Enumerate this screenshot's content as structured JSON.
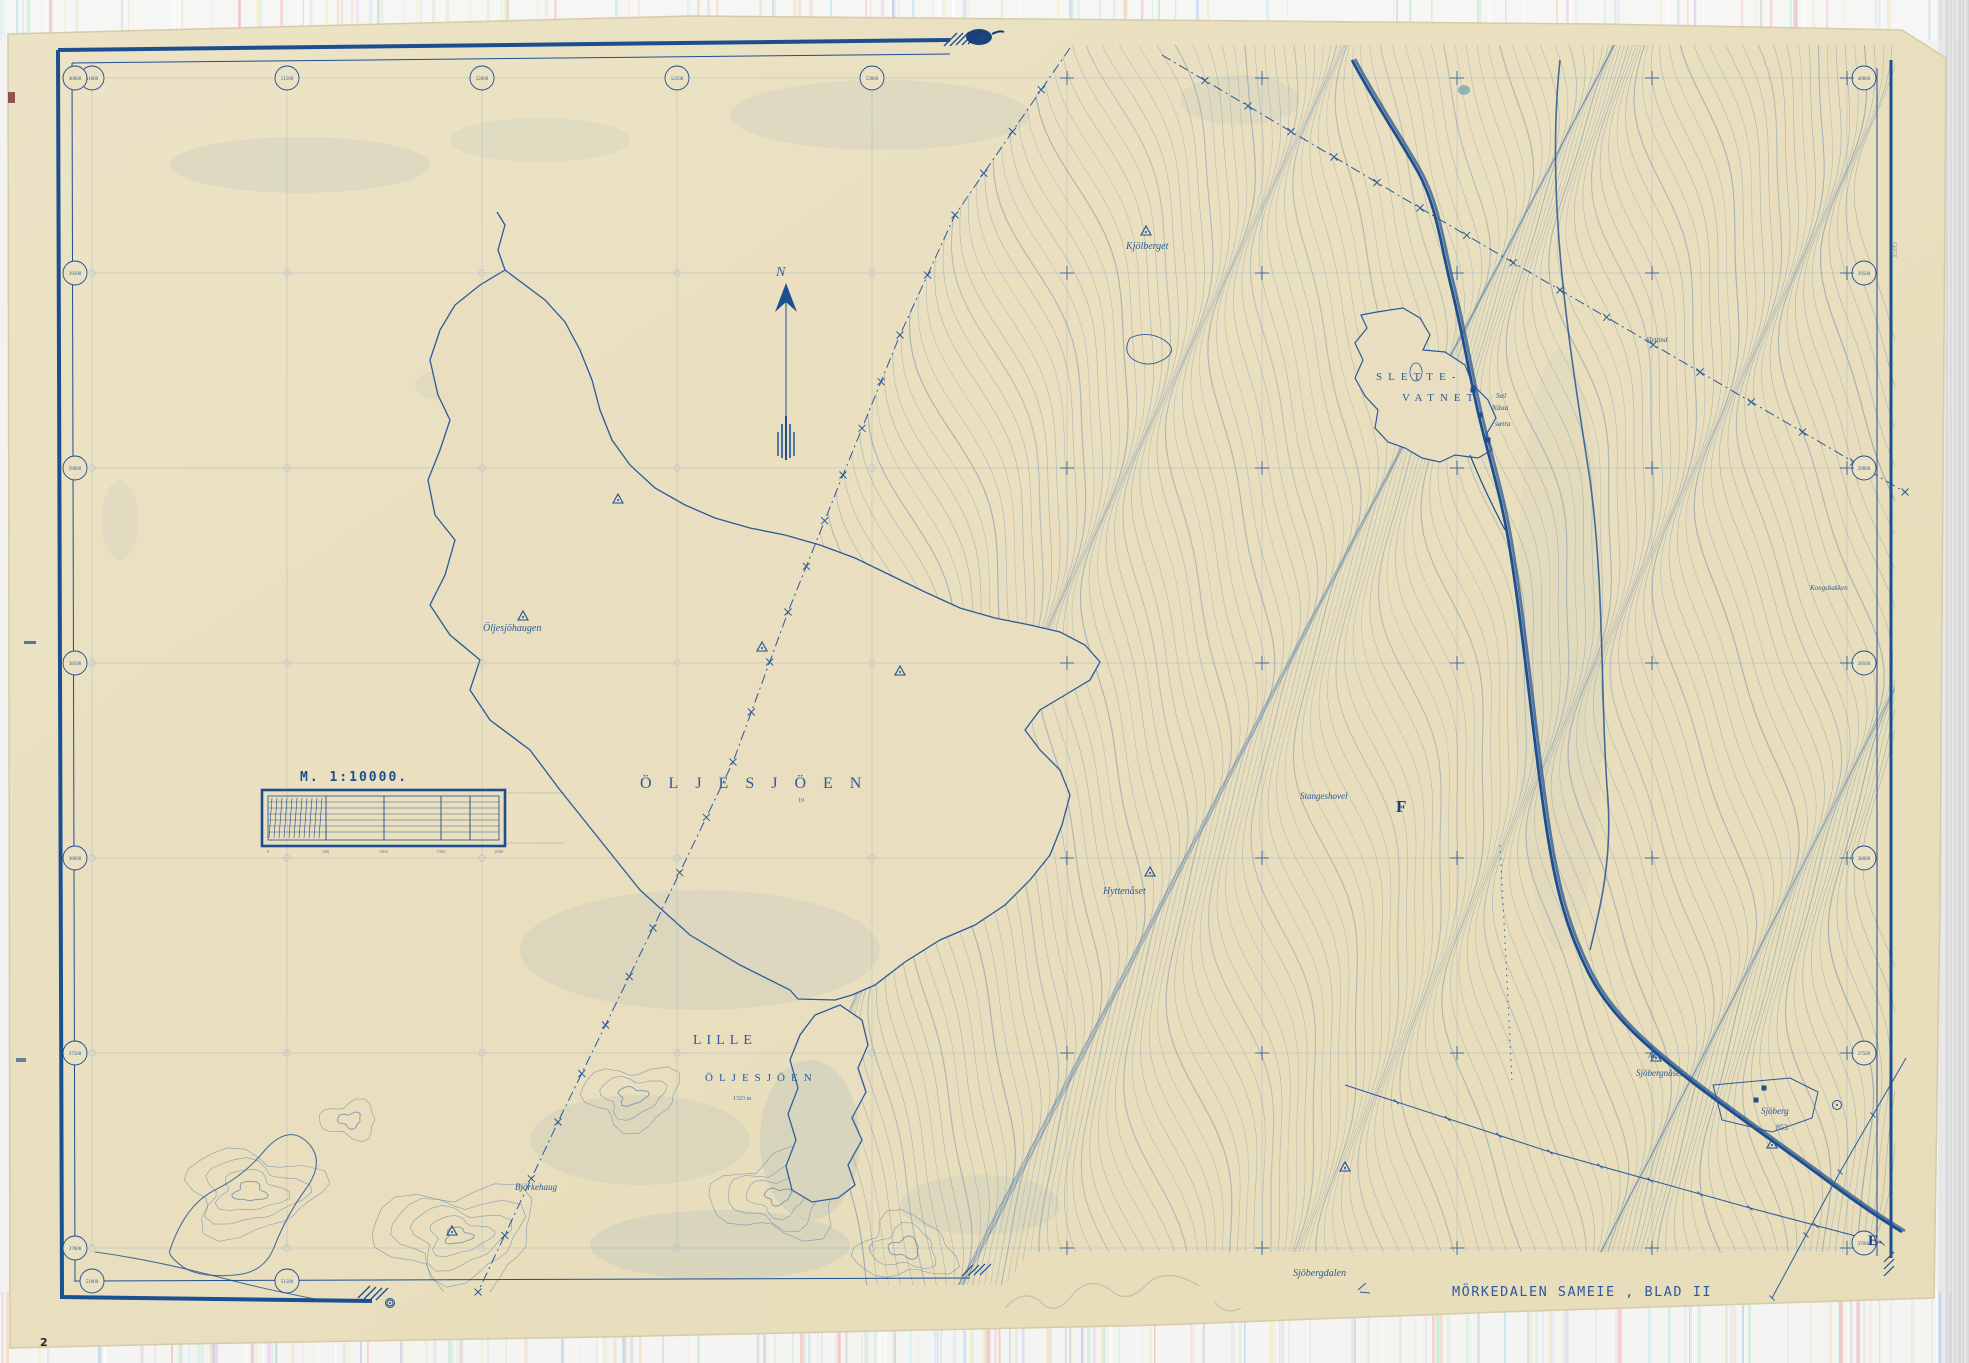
{
  "colors": {
    "paper": "#eae0c2",
    "ink": "#1d4e8f",
    "mid": "#33639c",
    "contour": "#4a74a5",
    "faint": "#9db1c6",
    "stamp": "#2d5a9e"
  },
  "title_block": {
    "text": "MÖRKEDALEN SAMEIE , BLAD II"
  },
  "scale": {
    "title": "M. 1:10000.",
    "ticks": [
      "0",
      "500",
      "1000",
      "1500",
      "2000"
    ]
  },
  "north": {
    "label": "N"
  },
  "margin_note": {
    "text": "1595"
  },
  "page_mark": {
    "text": "2"
  },
  "labels": {
    "oljesjoen": {
      "text": "ÖLJESJÖEN"
    },
    "oljesjoen_depth": {
      "text": "19"
    },
    "lille1": {
      "text": "LILLE"
    },
    "lille2": {
      "text": "ÖLJESJÖEN"
    },
    "lille_elev": {
      "text": "1323 m"
    },
    "slette1": {
      "text": "SLETTE-"
    },
    "slette2": {
      "text": "VATNET"
    },
    "oljesjohaugen": {
      "text": "Öljesjöhaugen"
    },
    "kjolberget": {
      "text": "Kjölberget"
    },
    "hyttenaset": {
      "text": "Hyttenåset"
    },
    "stangeshovel": {
      "text": "Stangeshovel"
    },
    "f_mark": {
      "text": "F"
    },
    "e_mark": {
      "text": "E"
    },
    "asen": {
      "text": "Åsen"
    },
    "sjobergnaset": {
      "text": "Sjöbergnåset"
    },
    "sjoberg": {
      "text": "Sjöberg"
    },
    "sjoberg_elev": {
      "text": "853"
    },
    "sjobergdalen": {
      "text": "Sjöbergdalen"
    },
    "slettind": {
      "text": "Slettind"
    },
    "kongsbakken": {
      "text": "Kongsbakken"
    },
    "bjorkehaug": {
      "text": "Björkehaug"
    },
    "sael": {
      "text": "Sæl"
    },
    "naasta": {
      "text": "Nåsta"
    },
    "saetra": {
      "text": "sætra"
    }
  },
  "grid": {
    "top": [
      {
        "x": 92,
        "v": "51000"
      },
      {
        "x": 287,
        "v": "51500"
      },
      {
        "x": 482,
        "v": "52000"
      },
      {
        "x": 677,
        "v": "52500"
      },
      {
        "x": 872,
        "v": "53000"
      }
    ],
    "bottom": [
      {
        "x": 92,
        "v": "51000"
      },
      {
        "x": 287,
        "v": "51500"
      }
    ],
    "left": [
      {
        "y": 78,
        "v": "40000"
      },
      {
        "y": 273,
        "v": "39500"
      },
      {
        "y": 468,
        "v": "39000"
      },
      {
        "y": 663,
        "v": "38500"
      },
      {
        "y": 858,
        "v": "38000"
      },
      {
        "y": 1053,
        "v": "37500"
      },
      {
        "y": 1248,
        "v": "37000"
      }
    ],
    "right": [
      {
        "y": 78,
        "v": "40000"
      },
      {
        "y": 273,
        "v": "39500"
      },
      {
        "y": 468,
        "v": "39000"
      },
      {
        "y": 663,
        "v": "38500"
      },
      {
        "y": 858,
        "v": "38000"
      },
      {
        "y": 1053,
        "v": "37500"
      },
      {
        "y": 1243,
        "v": "37000"
      }
    ]
  },
  "markers": {
    "summits": [
      [
        523,
        617
      ],
      [
        618,
        500
      ],
      [
        762,
        648
      ],
      [
        900,
        672
      ],
      [
        1146,
        232
      ],
      [
        1150,
        873
      ],
      [
        1656,
        1058
      ],
      [
        1345,
        1168
      ],
      [
        452,
        1232
      ],
      [
        1772,
        1145
      ]
    ],
    "buildings": [
      [
        1473,
        390
      ],
      [
        1480,
        415
      ],
      [
        1488,
        440
      ],
      [
        1756,
        1100
      ],
      [
        1764,
        1088
      ]
    ],
    "rings": [
      [
        1837,
        1105
      ],
      [
        390,
        1303
      ]
    ]
  }
}
